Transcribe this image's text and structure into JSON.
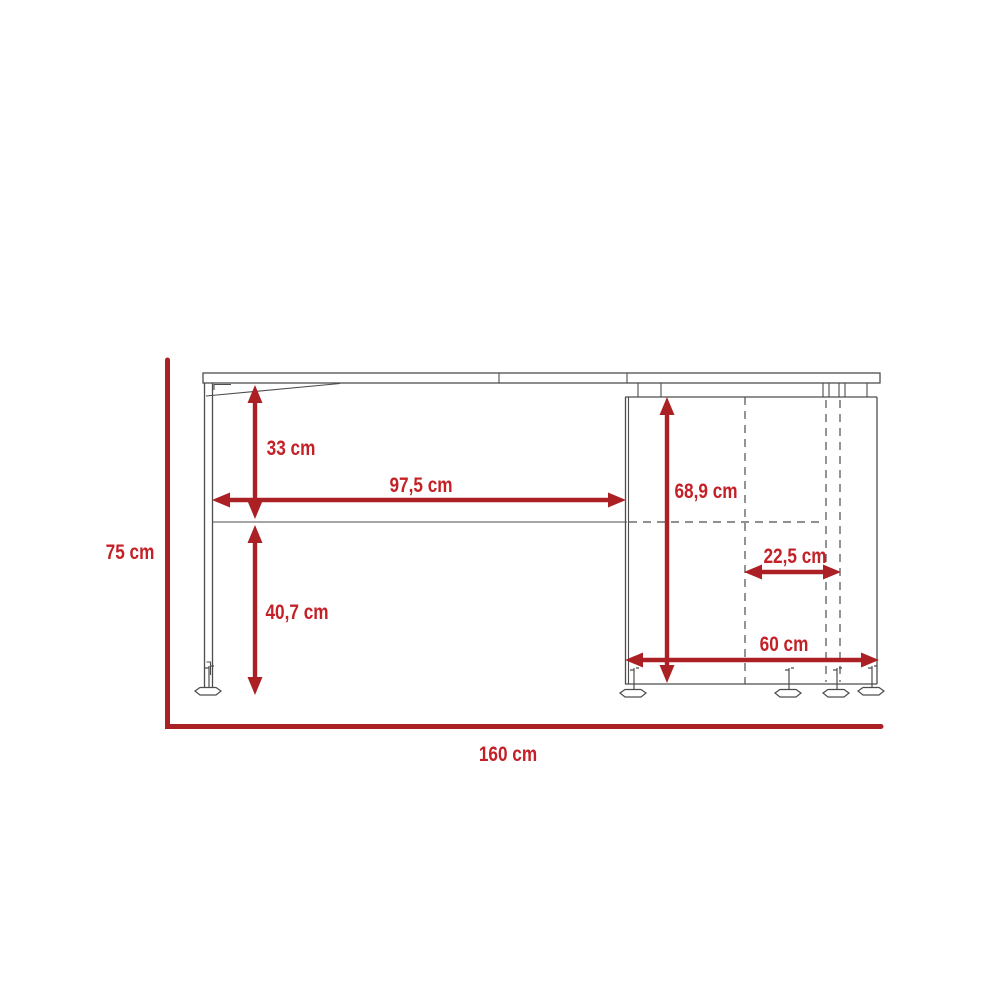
{
  "diagram": {
    "type": "furniture-dimension-drawing",
    "subject": "desk side elevation with measurement callouts",
    "unit": "cm",
    "colors": {
      "dimension_line": "#ab2025",
      "dimension_text": "#c32127",
      "drawing_line": "#4d4d4d",
      "background": "#ffffff"
    },
    "dimensions": {
      "overall_height": "75 cm",
      "overall_width": "160 cm",
      "desktop_to_rail": "33 cm",
      "rail_to_floor": "40,7 cm",
      "leg_to_cabinet_span": "97,5 cm",
      "cabinet_height": "68,9 cm",
      "cabinet_inner_offset": "22,5 cm",
      "cabinet_width": "60 cm"
    }
  }
}
